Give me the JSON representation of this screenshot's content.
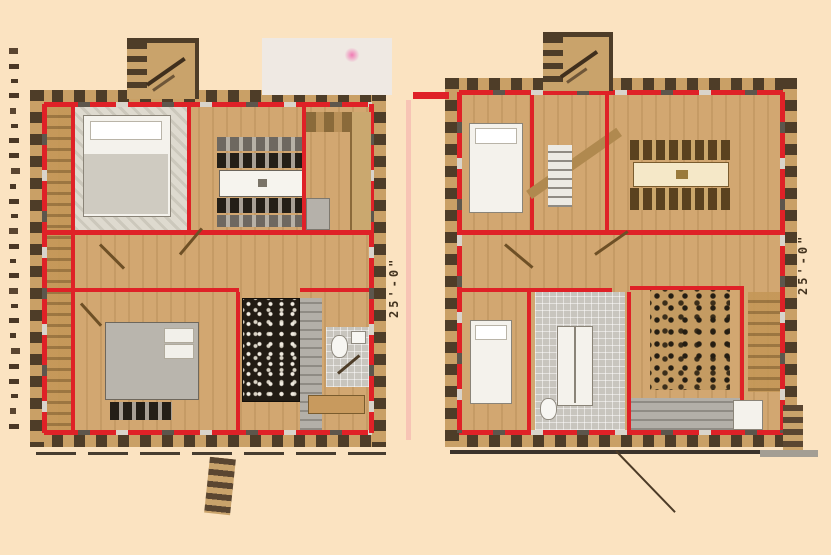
{
  "figure": {
    "type": "log-home-floor-plan",
    "plans": [
      {
        "name": "left-floor-plan",
        "dimension_label": "25'-0\""
      },
      {
        "name": "right-floor-plan",
        "dimension_label": "25'-0\""
      }
    ]
  },
  "palette": {
    "background": "#fbe3c1",
    "wall_red": "#df2127",
    "log_dark": "#4e3d28",
    "log_tan": "#c9a066",
    "floor_tan": "#d2a771",
    "tile_gray": "#c8c5be",
    "stone_black": "#221c14",
    "accent_pink": "#ef7fb6",
    "ink": "#43331f"
  },
  "watermark": {
    "tick_count": 26
  }
}
